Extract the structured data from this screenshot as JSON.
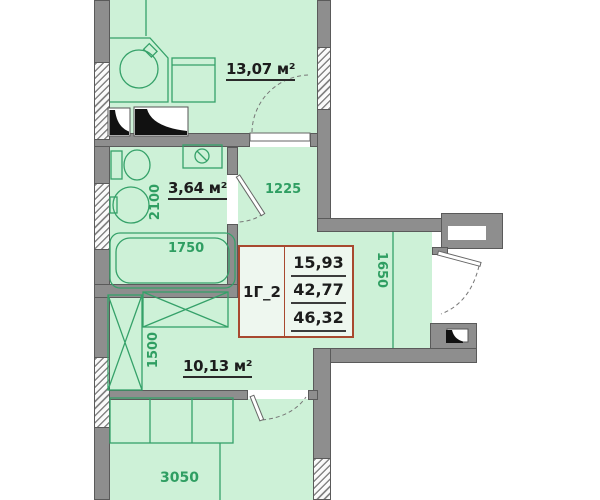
{
  "colors": {
    "room-fill": "#cdf1d7",
    "table-fill": "#eef7ef",
    "wall-gray": "#8e8e8e",
    "wall-edge": "#5a5a5a",
    "line-green": "#35a169",
    "dim-green": "#2f9e62",
    "label-dark": "#1c1c1c",
    "table-border": "#a8492f"
  },
  "rooms": {
    "kitchen": {
      "area": "13,07 м²"
    },
    "bathroom": {
      "area": "3,64 м²"
    },
    "hall": {
      "area": "10,13 м²"
    }
  },
  "dimensions": {
    "bathroom_width": "2100",
    "bathtub_length": "1750",
    "hallway_width": "1225",
    "entry_wall": "1650",
    "wardrobe_wall": "1500",
    "bedroom_width": "3050"
  },
  "info_table": {
    "unit_type": "1Г_2",
    "living_area": "15,93",
    "apartment_area": "42,77",
    "total_area": "46,32"
  }
}
